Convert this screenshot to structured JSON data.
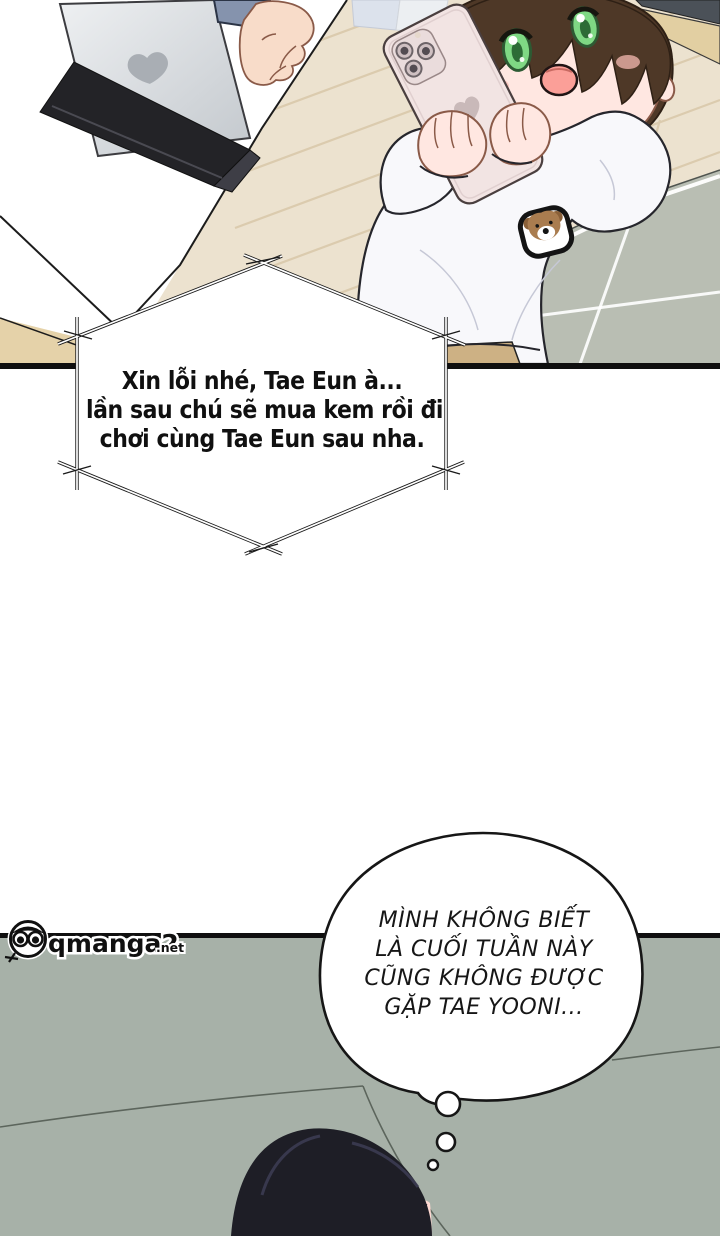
{
  "speech_bubble": {
    "lines": [
      "Xin lỗi nhé, Tae Eun à...",
      "lần sau chú sẽ mua kem rồi đi",
      "chơi cùng Tae Eun sau nha."
    ]
  },
  "thought_bubble": {
    "lines": [
      "MÌNH KHÔNG BIẾT",
      "LÀ CUỐI TUẦN NÀY",
      "CŨNG KHÔNG ĐƯỢC",
      "GẶP TAE YOONI..."
    ]
  },
  "watermark": {
    "name": "qmanga2",
    "tld": ".net"
  },
  "colors": {
    "panel_border": "#0f0f0f",
    "couch": "#a7b1a8",
    "floor_wood": "#ece2cf",
    "plank_line": "#dbcbae",
    "tile_mat": "#b9beb3",
    "tile_line": "#ffffff",
    "desk_wood": "#e5d2a9",
    "wall_wood": "#e2cfa2",
    "wall_dark": "#4b5158",
    "stand_black": "#232327",
    "sleeve_blue": "#8593ad",
    "skin": "#f8dcc9",
    "child_skin": "#ffe7e1",
    "hair_brown": "#4e3827",
    "hair_black": "#1e1e26",
    "eye_green": "#7fd884",
    "phone_pink": "#f2e4e3",
    "patch_brown": "#a97c4f",
    "blush_pink": "#f6b9b1",
    "mouth_pink": "#fb9f98",
    "sweatshirt": "#f8f8fb",
    "pants_tan": "#cdb184",
    "seam_green": "#5c655c",
    "ink": "#161616"
  }
}
